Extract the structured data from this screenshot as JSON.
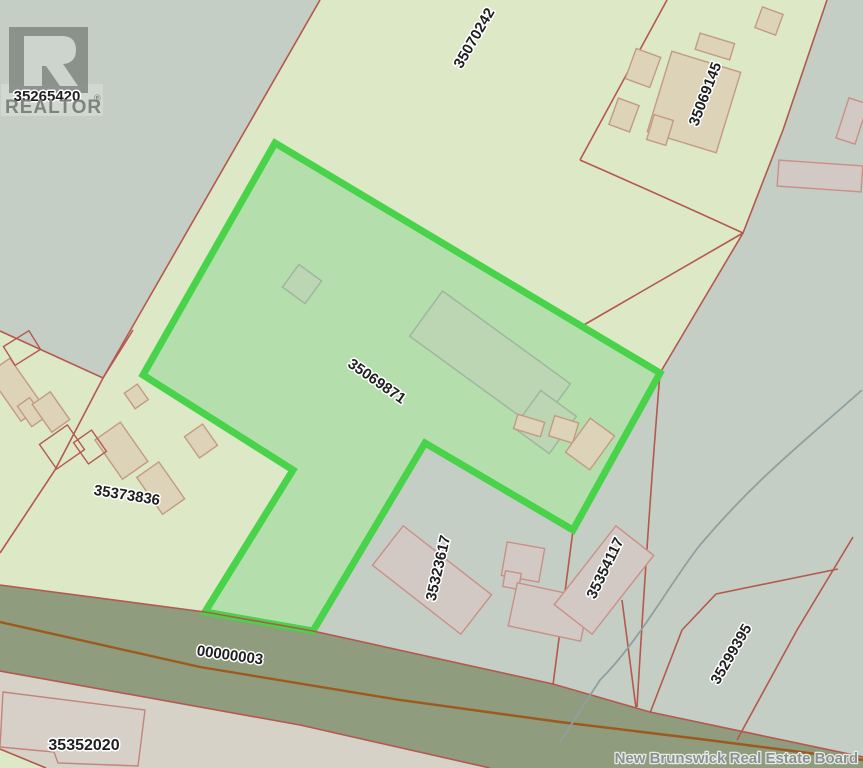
{
  "map": {
    "type": "cadastral-parcel-map",
    "highlighted_pid": "35069871",
    "parcels": {
      "northwest": {
        "pid": "35265420"
      },
      "north": {
        "pid": "35070242"
      },
      "northeast": {
        "pid": "35069145"
      },
      "highlighted": {
        "pid": "35069871"
      },
      "west": {
        "pid": "35373836"
      },
      "south_center": {
        "pid": "35323617"
      },
      "south_east": {
        "pid": "35354117"
      },
      "far_south_east": {
        "pid": "35299395"
      },
      "south_west": {
        "pid": "35352020"
      }
    },
    "road": {
      "pid": "00000003"
    },
    "watermark": {
      "text": "New Brunswick Real Estate Board"
    },
    "logo": {
      "brand": "REALTOR",
      "registered": "®"
    }
  },
  "colors": {
    "background_green": "#dce8c6",
    "parcel_gray": "#c4cec4",
    "parcel_pinkgray": "#d6d2c8",
    "highlight_fill": "#b4dfac",
    "highlight_border": "#48d34a",
    "boundary_red": "#b5584e",
    "road_fill": "#8f9c7e",
    "road_centerline": "#9c5a1e",
    "building_tan": "#ddd3b8",
    "building_tan_outline": "#c49a82",
    "building_pink": "#d2c9c4",
    "building_pink_outline": "#ca8f88",
    "label_color": "#1f1f1f",
    "watermark_color": "#8a9190"
  }
}
